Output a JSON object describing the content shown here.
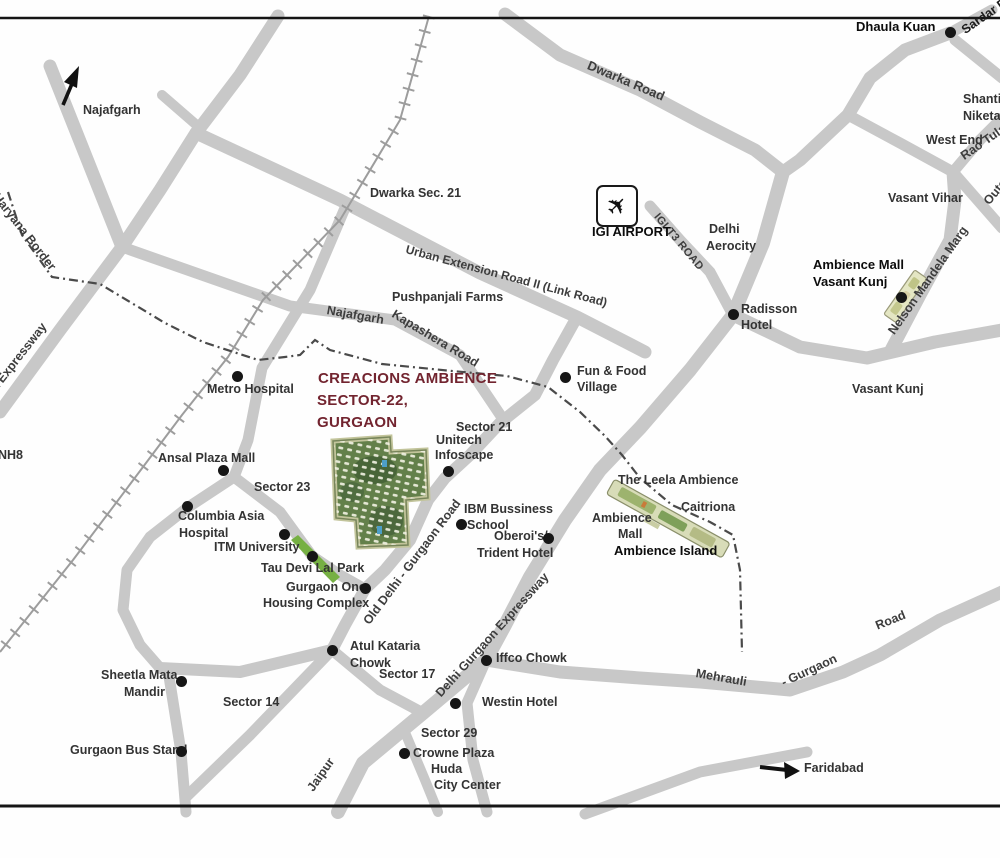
{
  "title": {
    "line1": "CREACIONS AMBIENCE",
    "line2": "SECTOR-22,",
    "line3": "GURGAON",
    "color": "#72242f"
  },
  "colors": {
    "road": "#c8c8c8",
    "railway": "#9d9d9d",
    "border_line": "#4a4a4a",
    "site_green": "#63804a",
    "park_green": "#76b043",
    "island_strip": "#d8dcb8",
    "label": "#333333"
  },
  "labels": {
    "najafgarh": "Najafgarh",
    "dwarka_road": "Dwarka Road",
    "dhaula_kuan": "Dhaula Kuan",
    "sardar": "Sardar Patel Marg",
    "shanti_1": "Shanti",
    "shanti_2": "Niketan",
    "west_end": "West End",
    "rao_tula": "Rao Tula Ram Marg",
    "outer_ring": "Outer Ring Road",
    "vasant_vihar": "Vasant Vihar",
    "dwarka_sec21": "Dwarka Sec. 21",
    "uer2": "Urban Extension Road II (Link Road)",
    "igi_airport": "IGI AIRPORT",
    "igi_t3": "IGI T3 ROAD",
    "aerocity_1": "Delhi",
    "aerocity_2": "Aerocity",
    "radisson_1": "Radisson",
    "radisson_2": "Hotel",
    "amb_vk_1": "Ambience Mall",
    "amb_vk_2": "Vasant Kunj",
    "nelson": "Nelson Mandela Marg",
    "vasant_kunj": "Vasant Kunj",
    "pushpanjali": "Pushpanjali Farms",
    "najafgarh_rd": "Najafgarh",
    "kapashera": "Kapashera Road",
    "metro": "Metro Hospital",
    "fun_food_1": "Fun & Food",
    "fun_food_2": "Village",
    "haryana_border": "Delhi - Haryana Border",
    "dwarka_expwy": "Dwarka Expressway",
    "nh8": "NH8",
    "sector21": "Sector 21",
    "unitech_1": "Unitech",
    "unitech_2": "Infoscape",
    "ansal": "Ansal Plaza Mall",
    "sector23": "Sector 23",
    "columbia_1": "Columbia Asia",
    "columbia_2": "Hospital",
    "itm": "ITM University",
    "tau": "Tau Devi Lal Park",
    "ibm_1": "IBM Bussiness",
    "ibm_2": "School",
    "oberoi_1": "Oberoi's/",
    "oberoi_2": "Trident Hotel",
    "old_delhi_rd": "Old Delhi - Gurgaon Road",
    "leela": "The Leela Ambience",
    "caitriona": "Caitriona",
    "amb_mall_1": "Ambience",
    "amb_mall_2": "Mall",
    "ambience_island": "Ambience Island",
    "gurgaon_one_1": "Gurgaon One",
    "gurgaon_one_2": "Housing Complex",
    "atul_1": "Atul Kataria",
    "atul_2": "Chowk",
    "sector17": "Sector 17",
    "dge": "Delhi Gurgaon Expressway",
    "iffco": "Iffco Chowk",
    "westin": "Westin Hotel",
    "sector29": "Sector 29",
    "crowne_1": "Crowne Plaza",
    "crowne_2": "Huda",
    "crowne_3": "City Center",
    "jaipur": "Jaipur",
    "mehrauli_1": "Mehrauli",
    "mehrauli_2": "- Gurgaon",
    "mehrauli_3": "Road",
    "faridabad": "Faridabad",
    "sheetla_1": "Sheetla Mata",
    "sheetla_2": "Mandir",
    "sector14": "Sector 14",
    "bus_stand": "Gurgaon Bus Stand"
  }
}
